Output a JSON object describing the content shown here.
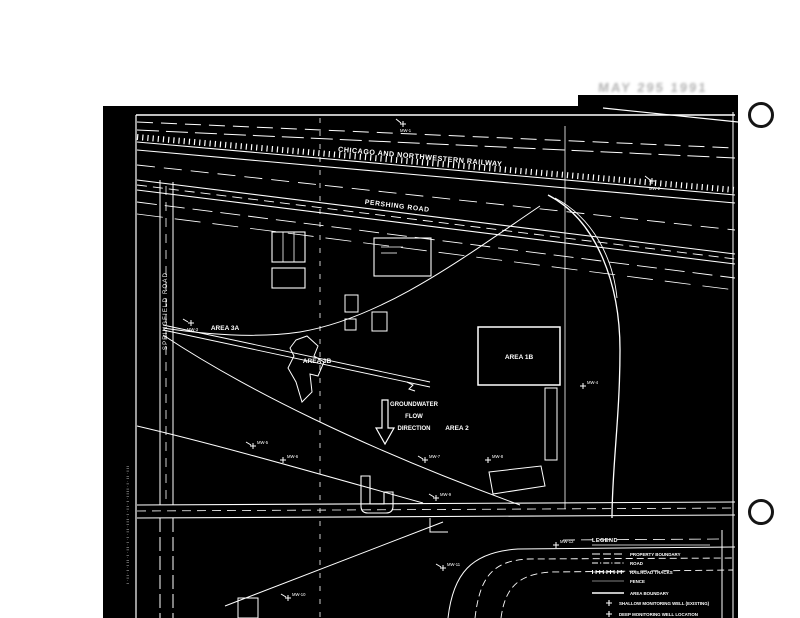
{
  "stamp": {
    "text": "MAY 295 1991"
  },
  "map": {
    "railway_label": "CHICAGO AND NORTHWESTERN RAILWAY",
    "pershing_label": "PERSHING ROAD",
    "left_road_label": "SPRINGFIELD ROAD",
    "areas": [
      {
        "label": "AREA 3A"
      },
      {
        "label": "AREA 3B"
      },
      {
        "label": "AREA 1B"
      },
      {
        "label": "AREA 2"
      }
    ],
    "groundwater_note": {
      "line1": "GROUNDWATER",
      "line2": "FLOW",
      "line3": "DIRECTION"
    },
    "wells": [
      {
        "id": "MW-1"
      },
      {
        "id": "MW-2"
      },
      {
        "id": "MW-3"
      },
      {
        "id": "MW-4"
      },
      {
        "id": "MW-5"
      },
      {
        "id": "MW-6"
      },
      {
        "id": "MW-7"
      },
      {
        "id": "MW-8"
      },
      {
        "id": "MW-9"
      },
      {
        "id": "MW-10"
      },
      {
        "id": "MW-11"
      },
      {
        "id": "MW-12"
      }
    ],
    "margin_marks": "l·ll·l·lll·l·ll·l·l·ll·lll·l·ll·l·llll·l·ll·lll"
  },
  "legend": {
    "title": "LEGEND",
    "entries": [
      {
        "symbol": "dashed-line",
        "label": "PROPERTY BOUNDARY"
      },
      {
        "symbol": "dash-dot-line",
        "label": "ROAD"
      },
      {
        "symbol": "railroad-line",
        "label": "RAILROAD TRACKS"
      },
      {
        "symbol": "thin-line",
        "label": "FENCE"
      },
      {
        "symbol": "solid-line",
        "label": "AREA BOUNDARY"
      },
      {
        "symbol": "cross",
        "label": "SHALLOW MONITORING WELL (EXISTING)"
      },
      {
        "symbol": "cross",
        "label": "DEEP MONITORING WELL LOCATION"
      }
    ]
  },
  "colors": {
    "scan_bg": "#000000",
    "ink": "#ffffff",
    "stamp": "#b3b3b3"
  }
}
